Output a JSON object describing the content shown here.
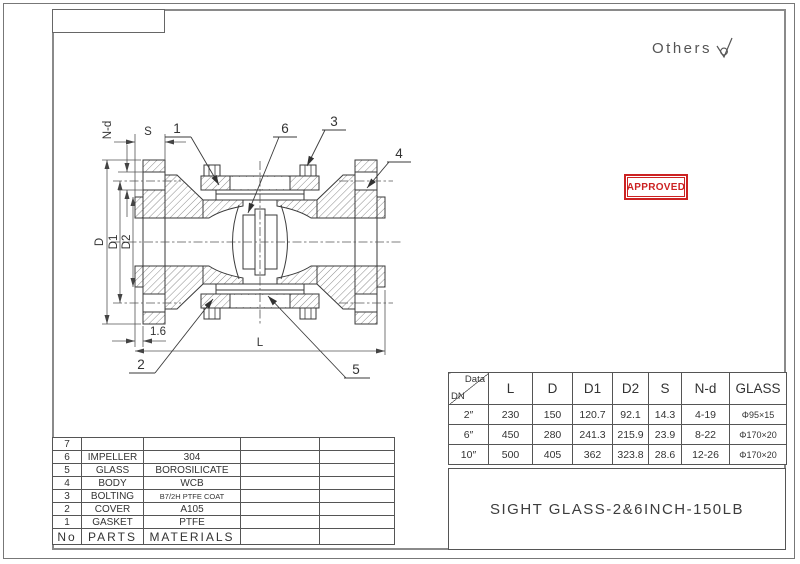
{
  "header": {
    "others_label": "Others"
  },
  "stamp": {
    "text": "APPROVED"
  },
  "colors": {
    "stamp_red": "#cc2222",
    "line": "#3a3a3a",
    "frame_gray": "#8a8a8a"
  },
  "drawing": {
    "callout_1": "1",
    "callout_2": "2",
    "callout_3": "3",
    "callout_4": "4",
    "callout_5": "5",
    "callout_6": "6",
    "dim_n_d": "N-d",
    "dim_s": "S",
    "dim_d": "D",
    "dim_d1": "D1",
    "dim_d2": "D2",
    "dim_rf": "1.6",
    "dim_l": "L"
  },
  "data_table": {
    "corner_top": "Data",
    "corner_bottom": "DN",
    "headers": [
      "L",
      "D",
      "D1",
      "D2",
      "S",
      "N-d",
      "GLASS"
    ],
    "rows": [
      {
        "dn": "2″",
        "l": "230",
        "d": "150",
        "d1": "120.7",
        "d2": "92.1",
        "s": "14.3",
        "nd": "4-19",
        "glass": "Φ95×15"
      },
      {
        "dn": "6″",
        "l": "450",
        "d": "280",
        "d1": "241.3",
        "d2": "215.9",
        "s": "23.9",
        "nd": "8-22",
        "glass": "Φ170×20"
      },
      {
        "dn": "10″",
        "l": "500",
        "d": "405",
        "d1": "362",
        "d2": "323.8",
        "s": "28.6",
        "nd": "12-26",
        "glass": "Φ170×20"
      }
    ]
  },
  "title_block": {
    "title": "SIGHT GLASS-2&6INCH-150LB"
  },
  "parts_table": {
    "rows": [
      {
        "no": "7",
        "part": "",
        "material": ""
      },
      {
        "no": "6",
        "part": "IMPELLER",
        "material": "304"
      },
      {
        "no": "5",
        "part": "GLASS",
        "material": "BOROSILICATE"
      },
      {
        "no": "4",
        "part": "BODY",
        "material": "WCB"
      },
      {
        "no": "3",
        "part": "BOLTING",
        "material": "B7/2H PTFE COAT"
      },
      {
        "no": "2",
        "part": "COVER",
        "material": "A105"
      },
      {
        "no": "1",
        "part": "GASKET",
        "material": "PTFE"
      }
    ],
    "footer": {
      "no": "No",
      "part": "PARTS",
      "material": "MATERIALS"
    }
  }
}
